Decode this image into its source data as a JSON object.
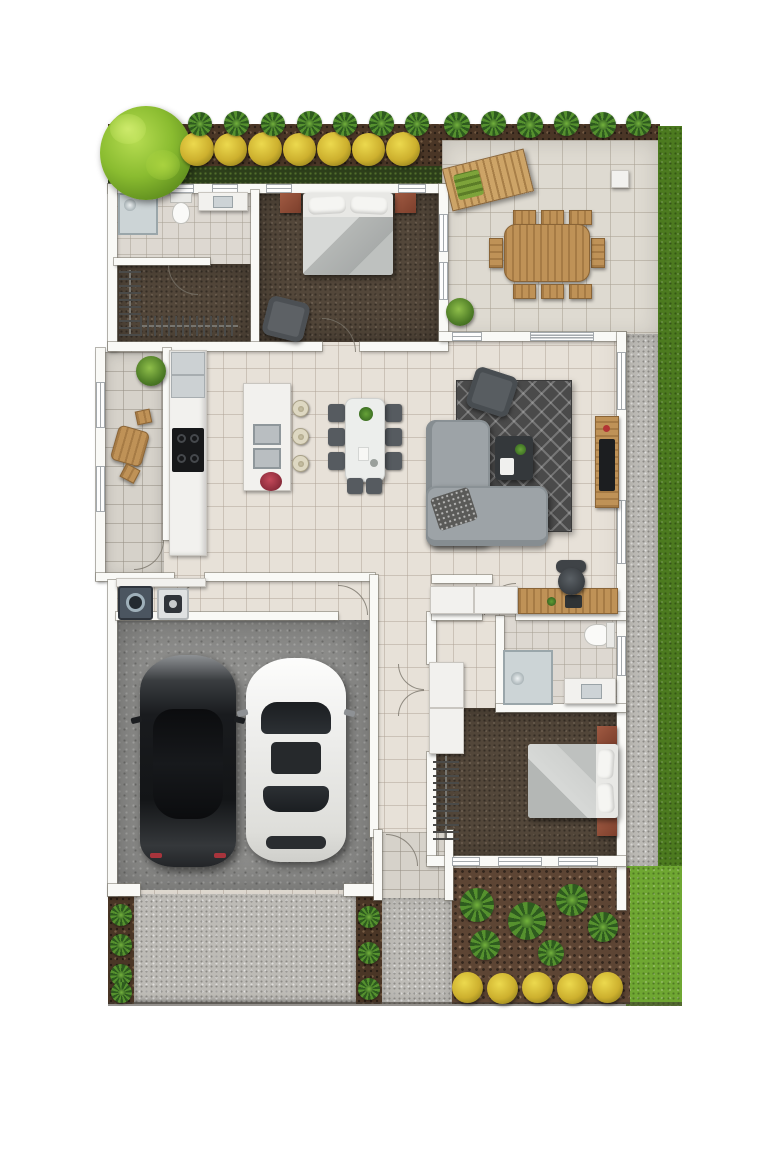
{
  "scene": {
    "kind": "architectural-floor-plan",
    "style": "photorealistic top-down 3D render",
    "visible_text": "none"
  },
  "palette": {
    "background": "#ffffff",
    "wall": "#f9f9f6",
    "interior_tile": "#e7e1d8",
    "patio_tile": "#dedad1",
    "carpet_brown": "#53473a",
    "garage_concrete": "#8f8f8d",
    "driveway_gravel": "#bdbbb6",
    "mulch": "#4a3626",
    "grass_dark": "#4c7a1f",
    "grass_bright": "#6fa732",
    "bush_yellow": "#cdb02e",
    "tree_green": "#8abc30",
    "sofa_gray": "#9da3a7",
    "rug_gray": "#4a4a4a",
    "wood_accent": "#bf9257",
    "nightstand_rust": "#8e4f3a",
    "car_dark": "#17191c",
    "car_white": "#f1f1ef"
  },
  "site": {
    "elements": [
      "top-garden-bed",
      "feature-tree",
      "yellow-bushes",
      "spiky-shrubs",
      "hedge-strip",
      "side-grass-strip",
      "gravel-side-path",
      "rear-patio",
      "driveway",
      "front-path",
      "front-garden-bed",
      "front-lawn",
      "plant-borders"
    ]
  },
  "rooms": [
    {
      "id": "ensuite",
      "furniture": [
        "shower",
        "toilet",
        "vanity"
      ]
    },
    {
      "id": "walk-in-robe",
      "furniture": [
        "clothes-rack-left",
        "clothes-rack-bottom"
      ]
    },
    {
      "id": "master-bedroom",
      "furniture": [
        "double-bed",
        "nightstand-left",
        "nightstand-right",
        "armchair"
      ]
    },
    {
      "id": "patio",
      "furniture": [
        "sun-lounger",
        "outdoor-dining-table",
        "outdoor-chairs",
        "side-cube-table",
        "potted-plant"
      ]
    },
    {
      "id": "courtyard",
      "furniture": [
        "potted-plant",
        "bistro-table",
        "bistro-chairs"
      ]
    },
    {
      "id": "kitchen",
      "furniture": [
        "fridge",
        "counter-run",
        "cooktop",
        "island-bench",
        "island-sinks",
        "flower-bowl",
        "bar-stools"
      ]
    },
    {
      "id": "dining",
      "furniture": [
        "dining-table",
        "dining-chairs",
        "table-plant"
      ]
    },
    {
      "id": "living",
      "furniture": [
        "patterned-rug",
        "l-shaped-sofa",
        "accent-armchair",
        "coffee-table",
        "tv-unit",
        "television"
      ]
    },
    {
      "id": "study-nook",
      "furniture": [
        "sideboard",
        "desk",
        "office-chair",
        "laptop"
      ]
    },
    {
      "id": "laundry",
      "furniture": [
        "washer",
        "dryer",
        "bench"
      ]
    },
    {
      "id": "garage",
      "furniture": [
        "dark-sedan",
        "white-sedan"
      ]
    },
    {
      "id": "hallway",
      "furniture": [
        "linen-cupboard"
      ]
    },
    {
      "id": "bathroom-2",
      "furniture": [
        "shower",
        "toilet",
        "vanity"
      ]
    },
    {
      "id": "bedroom-2",
      "furniture": [
        "double-bed",
        "nightstand-top",
        "nightstand-bottom",
        "wardrobe-rack"
      ]
    },
    {
      "id": "entry-porch",
      "furniture": []
    }
  ],
  "vehicles": [
    {
      "id": "dark-sedan",
      "color": "#17191c",
      "position": "garage-left-bay"
    },
    {
      "id": "white-sedan",
      "color": "#f1f1ef",
      "position": "garage-right-bay"
    }
  ]
}
